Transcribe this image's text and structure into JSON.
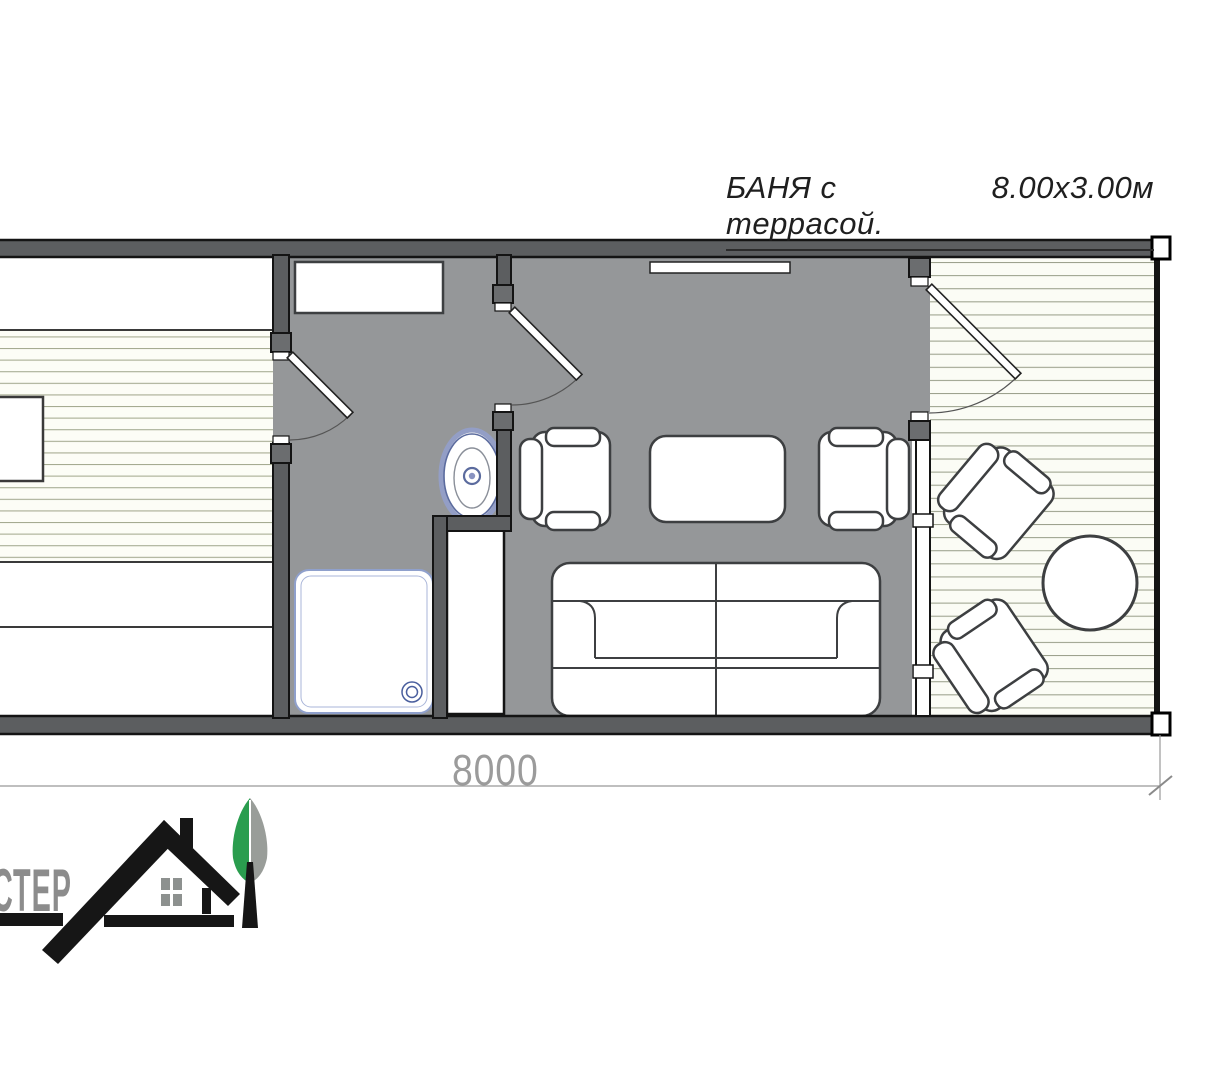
{
  "title": {
    "name": "БАНЯ с террасой.",
    "size": "8.00х3.00м"
  },
  "dimension": {
    "width": "8000"
  },
  "logo": {
    "text": "СТЕР",
    "icons": [
      "house-icon",
      "tree-icon"
    ],
    "green": "#2a9d4e",
    "gray": "#8c8c8c"
  },
  "plan": {
    "icons": [
      "stove",
      "sauna-bench",
      "wall",
      "door",
      "window",
      "shelf-bench",
      "wash-sink",
      "shower-tray",
      "cabinet",
      "armchair",
      "coffee-table",
      "sofa",
      "round-table",
      "terrace-deck"
    ],
    "colors": {
      "wall_fill": "#5c5e60",
      "wet_floor": "#959799",
      "plank_floor": "#fcfdf6",
      "plank_line": "#a3a98f",
      "outline": "#141414",
      "furniture_outline": "#3d3f41",
      "fixture_blue": "#8f9cc9",
      "dimension_gray": "#9b9b9b"
    }
  }
}
